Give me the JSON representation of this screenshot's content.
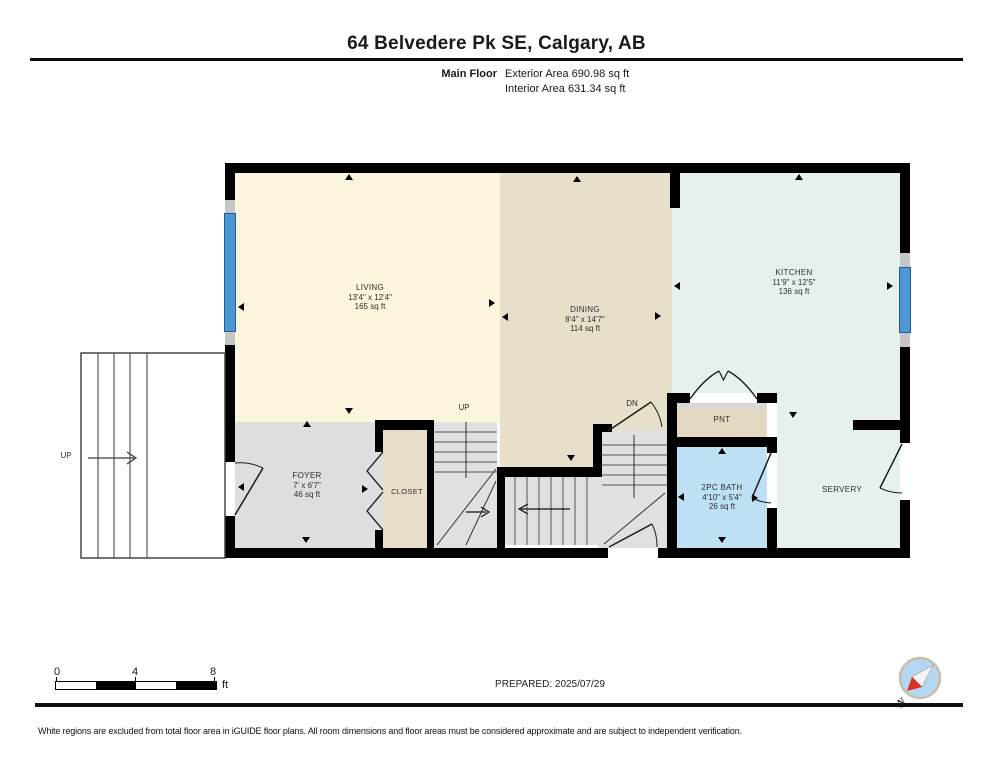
{
  "header": {
    "title": "64 Belvedere Pk SE, Calgary, AB",
    "floor_label": "Main Floor",
    "exterior_area": "Exterior Area 690.98 sq ft",
    "interior_area": "Interior Area 631.34 sq ft"
  },
  "plan": {
    "rooms": {
      "living": {
        "name": "LIVING",
        "dims": "13'4\" x 12'4\"",
        "area": "165 sq ft"
      },
      "dining": {
        "name": "DINING",
        "dims": "8'4\" x 14'7\"",
        "area": "114 sq ft"
      },
      "kitchen": {
        "name": "KITCHEN",
        "dims": "11'9\" x 12'5\"",
        "area": "136 sq ft"
      },
      "foyer": {
        "name": "FOYER",
        "dims": "7' x 6'7\"",
        "area": "46 sq ft"
      },
      "closet": {
        "name": "CLOSET"
      },
      "pantry": {
        "name": "PNT"
      },
      "bath": {
        "name": "2PC BATH",
        "dims": "4'10\" x 5'4\"",
        "area": "26 sq ft"
      },
      "servery": {
        "name": "SERVERY"
      },
      "porch": {
        "name": "PORCH"
      }
    },
    "stair_labels": {
      "up": "UP",
      "dn": "DN",
      "porch_up": "UP"
    }
  },
  "footer": {
    "scale": {
      "ticks": [
        "0",
        "4",
        "8"
      ],
      "unit": "ft"
    },
    "prepared": "PREPARED: 2025/07/29",
    "compass_label": "N",
    "disclaimer": "White regions are excluded from total floor area in iGUIDE floor plans. All room dimensions and floor areas must be considered approximate and are subject to independent verification."
  },
  "colors": {
    "wall": "#000000",
    "living": "#FBF5DD",
    "dining": "#E6DFC9",
    "kitchen": "#E7F1EB",
    "foyer_stairs": "#DEDEDE",
    "closet": "#E9DECA",
    "pantry": "#E5D8C2",
    "bath": "#BEE0F4",
    "window": "#4E97D1",
    "compass_fill": "#B4D8F2",
    "compass_needle": "#D93025"
  }
}
